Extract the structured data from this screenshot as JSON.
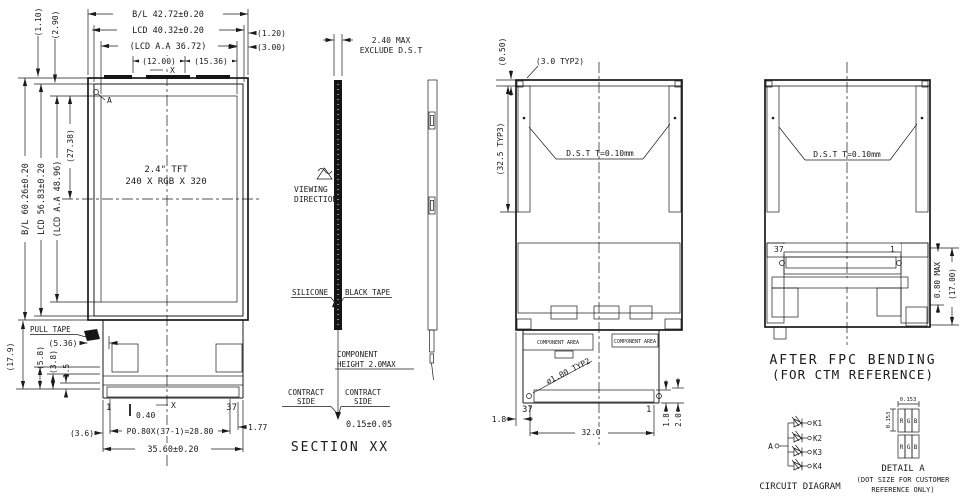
{
  "front_view": {
    "dim_bl_width": "B/L 42.72±0.20",
    "dim_lcd_width": "LCD 40.32±0.20",
    "dim_aa_width": "(LCD A.A 36.72)",
    "dim_12_00": "(12.00)",
    "dim_15_36": "(15.36)",
    "dim_1_20": "(1.20)",
    "dim_3_00": "(3.00)",
    "dim_1_10": "(1.10)",
    "dim_2_90": "(2.90)",
    "dim_bl_height": "B/L 60.26±0.20",
    "dim_lcd_height": "LCD 56.83±0.20",
    "dim_aa_height": "(LCD A.A 48.96)",
    "dim_27_38": "(27.38)",
    "datum_a": "A",
    "datum_x_top": "X",
    "datum_x_bottom": "X",
    "panel_size": "2.4\" TFT",
    "panel_resolution": "240 X RGB X 320",
    "pull_tape": "PULL TAPE",
    "dim_5_36": "(5.36)",
    "dim_17_9": "(17.9)",
    "dim_5_8": "(5.8)",
    "dim_3_8": "(3.8)",
    "dim_1_5": "1.5",
    "pin_first": "1",
    "pin_last": "37",
    "dim_0_40": "0.40",
    "dim_pitch": "P0.80X(37-1)=28.80",
    "dim_1_77": "1.77",
    "dim_fpc_width": "35.60±0.20",
    "dim_3_6": "(3.6)"
  },
  "section_view": {
    "title": "SECTION XX",
    "dim_thickness_line1": "2.40 MAX",
    "dim_thickness_line2": "EXCLUDE D.S.T",
    "viewing_line1": "VIEWING",
    "viewing_line2": "DIRECTION",
    "silicone": "SILICONE",
    "black_tape": "BLACK TAPE",
    "component_line1": "COMPONENT",
    "component_line2": "HEIGHT 2.0MAX",
    "contact_left_line1": "CONTRACT",
    "contact_left_line2": "SIDE",
    "contact_right_line1": "CONTRACT",
    "contact_right_line2": "SIDE",
    "dim_fpc_thickness": "0.15±0.05"
  },
  "rear_view": {
    "dim_0_50": "(0.50)",
    "dim_3_0": "(3.0 TYP2)",
    "dim_32_5": "(32.5 TYP3)",
    "dst_note": "D.S.T T=0.10mm",
    "component_area_1": "COMPONENT AREA",
    "component_area_2": "COMPONENT AREA",
    "hole_note": "∅1.00 TYP2",
    "pin_last": "37",
    "pin_first": "1",
    "dim_1_8_left": "1.8",
    "dim_32_0": "32.0",
    "dim_1_8_right": "1.8",
    "dim_2_0": "2.0"
  },
  "bent_view": {
    "dst_note": "D.S.T T=0.10mm",
    "pin_last": "37",
    "pin_first": "1",
    "dim_0_80": "0.80 MAX",
    "dim_17_00": "(17.00)",
    "caption_line1": "AFTER FPC BENDING",
    "caption_line2": "(FOR CTM REFERENCE)"
  },
  "circuit": {
    "anode": "A",
    "cathodes": [
      "K1",
      "K2",
      "K3",
      "K4"
    ],
    "caption": "CIRCUIT DIAGRAM"
  },
  "detail_a": {
    "dim_top": "0.153",
    "dim_left": "0.153",
    "row1": [
      "R",
      "G",
      "B"
    ],
    "row2": [
      "R",
      "G",
      "B"
    ],
    "title": "DETAIL A",
    "note_line1": "(DOT SIZE FOR CUSTOMER",
    "note_line2": "REFERENCE ONLY)"
  }
}
